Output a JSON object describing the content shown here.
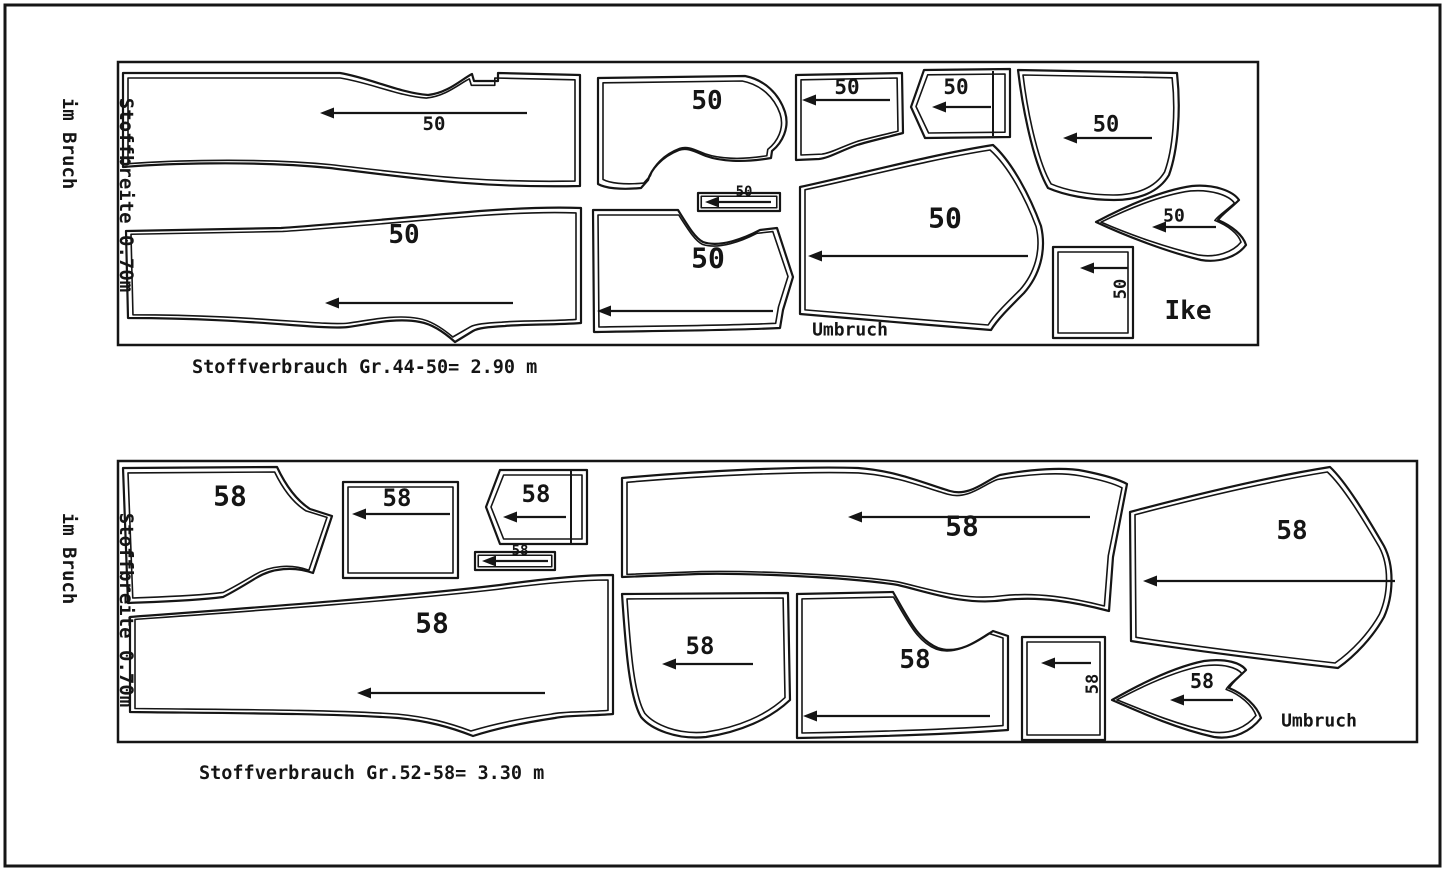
{
  "colors": {
    "ink": "#151515",
    "background": "#ffffff"
  },
  "page_border": {
    "x": 5,
    "y": 5,
    "w": 1435,
    "h": 861
  },
  "layouts": [
    {
      "name": "cutting-layout-size-44-50",
      "frame": {
        "x": 118,
        "y": 62,
        "w": 1140,
        "h": 283
      },
      "side_label": {
        "line1": "Stoffbreite 0.70m",
        "line2": "im Bruch"
      },
      "usage_text": "Stoffverbrauch Gr.44-50= 2.90 m",
      "annotations": [
        {
          "name": "umbruch-note",
          "text": "Umbruch",
          "x": 850,
          "y": 330,
          "size": 18
        },
        {
          "name": "ike-signature",
          "text": "Ike",
          "x": 1188,
          "y": 311,
          "size": 26
        }
      ],
      "pieces": [
        {
          "name": "trouser-front-piece",
          "d": "M123,73 L340,73 C370,78 400,93 428,95 C448,93 462,79 472,74 L474,81 L498,81 L498,73 L580,75 L580,186 C480,188 420,179 330,168 C250,160 160,164 123,167 Z",
          "label": {
            "text": "50",
            "x": 434,
            "y": 124,
            "size": 19
          },
          "arrow": {
            "head": [
              320,
              113
            ],
            "tail": [
              527,
              113
            ]
          }
        },
        {
          "name": "trouser-back-piece",
          "d": "M126,231 L281,228 C340,224 420,216 480,211 C520,208 555,207 581,208 L581,323 C555,325 525,324 505,326 C488,327 478,328 473,331 L455,342 C445,333 432,324 420,322 C395,317 365,325 348,327 C320,330 250,318 128,318 Z",
          "label": {
            "text": "50",
            "x": 404,
            "y": 235,
            "size": 26
          },
          "arrow": {
            "head": [
              325,
              303
            ],
            "tail": [
              513,
              303
            ]
          }
        },
        {
          "name": "jacket-front-piece",
          "d": "M598,78 L745,76 C765,80 779,94 785,112 C790,128 782,143 772,151 L771,158 C742,163 720,161 706,156 C694,151 687,147 679,150 C661,157 651,170 648,180 L641,188 C620,190 605,188 598,184 Z",
          "label": {
            "text": "50",
            "x": 707,
            "y": 101,
            "size": 26
          },
          "arrow": null
        },
        {
          "name": "jacket-back-piece",
          "d": "M593,210 L678,210 C688,226 695,238 703,242 C720,248 745,238 760,230 L777,228 L793,277 L783,310 L780,328 C715,331 640,331 594,332 Z",
          "label": {
            "text": "50",
            "x": 708,
            "y": 258,
            "size": 28
          },
          "arrow": {
            "head": [
              597,
              311
            ],
            "tail": [
              773,
              311
            ]
          }
        },
        {
          "name": "waistband-strip",
          "d": "M698,193 L780,193 L780,211 L698,211 Z",
          "label": {
            "text": "50",
            "x": 744,
            "y": 192,
            "size": 14
          },
          "arrow": {
            "head": [
              705,
              202
            ],
            "tail": [
              771,
              202
            ]
          }
        },
        {
          "name": "pocket-piece-a",
          "d": "M796,75 L902,73 L903,133 C888,137 870,141 857,145 C840,151 829,158 819,159 L796,160 Z",
          "label": {
            "text": "50",
            "x": 847,
            "y": 87,
            "size": 21
          },
          "arrow": {
            "head": [
              802,
              100
            ],
            "tail": [
              890,
              100
            ]
          }
        },
        {
          "name": "pocket-piece-b",
          "d": "M924,70 L1010,69 L1010,137 L925,138 L911,107 Z",
          "extra": [
            "M993,71 L993,136"
          ],
          "label": {
            "text": "50",
            "x": 956,
            "y": 87,
            "size": 21
          },
          "arrow": {
            "head": [
              932,
              107
            ],
            "tail": [
              991,
              107
            ]
          }
        },
        {
          "name": "sleeve-piece",
          "d": "M1018,70 L1177,73 C1181,110 1178,150 1169,175 C1159,192 1139,200 1114,200 C1089,200 1064,195 1048,188 C1036,168 1024,120 1018,70 Z",
          "label": {
            "text": "50",
            "x": 1106,
            "y": 125,
            "size": 22
          },
          "arrow": {
            "head": [
              1063,
              138
            ],
            "tail": [
              1152,
              138
            ]
          }
        },
        {
          "name": "coat-back-piece",
          "d": "M800,187 C860,174 930,155 993,145 C1012,162 1030,196 1041,226 C1047,252 1039,276 1024,293 C1009,308 997,320 991,330 C928,325 858,319 800,314 Z",
          "label": {
            "text": "50",
            "x": 945,
            "y": 218,
            "size": 28
          },
          "arrow": {
            "head": [
              808,
              256
            ],
            "tail": [
              1028,
              256
            ]
          }
        },
        {
          "name": "collar-piece",
          "d": "M1096,222 C1130,204 1164,190 1192,186 C1214,184 1233,191 1239,200 C1230,209 1222,214 1218,220 C1232,226 1243,235 1246,245 C1237,257 1219,263 1201,260 C1168,252 1128,237 1096,222 Z",
          "label": {
            "text": "50",
            "x": 1174,
            "y": 216,
            "size": 18
          },
          "arrow": {
            "head": [
              1152,
              227
            ],
            "tail": [
              1216,
              227
            ]
          }
        },
        {
          "name": "pocket-square",
          "d": "M1053,247 L1133,247 L1133,338 L1053,338 Z",
          "label": {
            "text": "50",
            "x": 1121,
            "y": 289,
            "size": 17,
            "rotate": -90
          },
          "arrow": {
            "head": [
              1080,
              268
            ],
            "tail": [
              1128,
              268
            ]
          }
        }
      ]
    },
    {
      "name": "cutting-layout-size-52-58",
      "frame": {
        "x": 118,
        "y": 461,
        "w": 1299,
        "h": 281
      },
      "side_label": {
        "line1": "Stoffbreite 0.70m",
        "line2": "im Bruch"
      },
      "usage_text": "Stoffverbrauch Gr.52-58= 3.30 m",
      "annotations": [
        {
          "name": "umbruch-note",
          "text": "Umbruch",
          "x": 1319,
          "y": 721,
          "size": 18
        }
      ],
      "pieces": [
        {
          "name": "jacket-front-piece",
          "d": "M123,468 L277,467 C285,484 296,500 310,509 L332,516 L313,573 C294,566 272,568 256,578 C243,586 231,593 223,597 C192,601 152,602 128,603 Z",
          "label": {
            "text": "58",
            "x": 230,
            "y": 496,
            "size": 28
          },
          "arrow": null
        },
        {
          "name": "pocket-square-a",
          "d": "M343,482 L458,482 L458,578 L343,578 Z",
          "label": {
            "text": "58",
            "x": 397,
            "y": 498,
            "size": 24
          },
          "arrow": {
            "head": [
              352,
              514
            ],
            "tail": [
              450,
              514
            ]
          }
        },
        {
          "name": "pocket-pentagon",
          "d": "M500,470 L587,470 L587,544 L500,544 L486,507 Z",
          "extra": [
            "M571,471 L571,543"
          ],
          "label": {
            "text": "58",
            "x": 536,
            "y": 494,
            "size": 24
          },
          "arrow": {
            "head": [
              503,
              517
            ],
            "tail": [
              566,
              517
            ]
          }
        },
        {
          "name": "waistband-strip",
          "d": "M475,552 L555,552 L555,570 L475,570 Z",
          "label": {
            "text": "58",
            "x": 520,
            "y": 551,
            "size": 14
          },
          "arrow": {
            "head": [
              482,
              561
            ],
            "tail": [
              548,
              561
            ]
          }
        },
        {
          "name": "trouser-leg-horizontal",
          "d": "M622,478 C700,471 800,466 858,468 C898,471 926,484 950,491 C970,497 986,480 1000,475 C1032,469 1064,467 1084,471 C1104,475 1118,479 1127,484 L1113,557 L1109,611 C1075,602 1040,596 1005,600 C965,606 928,592 898,585 C848,577 748,573 698,574 L622,577 Z",
          "label": {
            "text": "58",
            "x": 962,
            "y": 526,
            "size": 28
          },
          "arrow": {
            "head": [
              848,
              517
            ],
            "tail": [
              1090,
              517
            ]
          }
        },
        {
          "name": "trouser-leg-long",
          "d": "M130,617 C250,608 400,597 500,585 C550,578 590,575 613,575 L613,714 C590,716 568,715 555,718 C528,722 498,728 473,736 C450,727 428,721 398,718 C330,713 200,713 130,712 Z",
          "label": {
            "text": "58",
            "x": 432,
            "y": 623,
            "size": 28
          },
          "arrow": {
            "head": [
              357,
              693
            ],
            "tail": [
              545,
              693
            ]
          }
        },
        {
          "name": "side-panel-a",
          "d": "M622,594 L788,593 L790,700 C770,719 740,732 706,737 C676,740 651,729 641,717 C630,698 626,655 622,594 Z",
          "label": {
            "text": "58",
            "x": 700,
            "y": 646,
            "size": 24
          },
          "arrow": {
            "head": [
              662,
              664
            ],
            "tail": [
              753,
              664
            ]
          }
        },
        {
          "name": "side-panel-b",
          "d": "M797,594 L893,592 C908,618 918,640 938,648 C958,655 978,641 993,631 L1008,636 L1008,730 C938,735 858,737 797,738 Z",
          "label": {
            "text": "58",
            "x": 915,
            "y": 660,
            "size": 26
          },
          "arrow": {
            "head": [
              803,
              716
            ],
            "tail": [
              990,
              716
            ]
          }
        },
        {
          "name": "pocket-square-b",
          "d": "M1022,637 L1105,637 L1105,740 L1022,740 Z",
          "label": {
            "text": "58",
            "x": 1093,
            "y": 684,
            "size": 17,
            "rotate": -90
          },
          "arrow": {
            "head": [
              1041,
              663
            ],
            "tail": [
              1091,
              663
            ]
          }
        },
        {
          "name": "sleeve-piece",
          "d": "M1130,512 C1190,496 1268,477 1330,467 C1346,482 1366,515 1384,546 C1395,567 1393,597 1384,617 C1373,637 1355,656 1338,668 C1268,660 1190,650 1131,641 Z",
          "label": {
            "text": "58",
            "x": 1292,
            "y": 531,
            "size": 26
          },
          "arrow": {
            "head": [
              1143,
              581
            ],
            "tail": [
              1395,
              581
            ]
          }
        },
        {
          "name": "collar-piece",
          "d": "M1112,700 C1140,684 1174,667 1204,661 C1226,658 1241,663 1246,670 C1238,678 1232,682 1229,688 C1244,694 1257,706 1261,718 C1251,731 1234,740 1214,737 C1178,729 1144,714 1112,700 Z",
          "label": {
            "text": "58",
            "x": 1202,
            "y": 681,
            "size": 20
          },
          "arrow": {
            "head": [
              1170,
              700
            ],
            "tail": [
              1233,
              700
            ]
          }
        }
      ]
    }
  ]
}
